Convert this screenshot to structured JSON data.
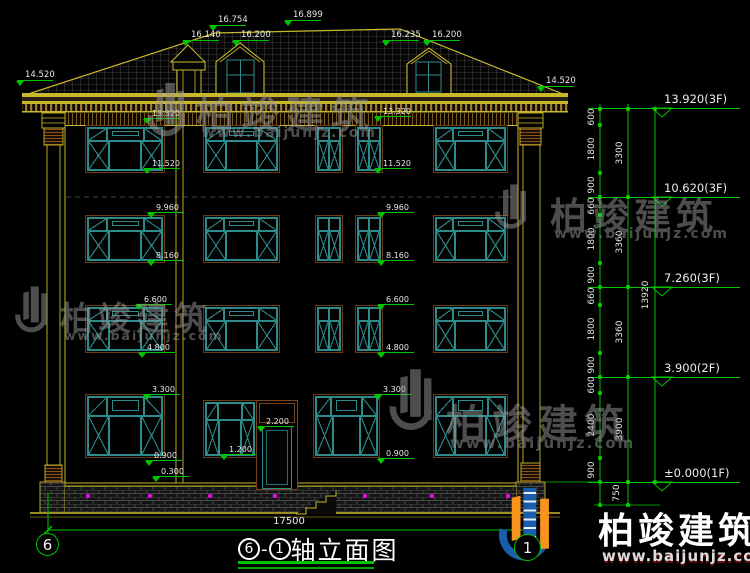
{
  "title": {
    "axis_left_bubble": "6",
    "axis_right_bubble": "1",
    "circled_left": "6",
    "dash": "-",
    "circled_right": "1",
    "text": "轴立面图"
  },
  "bottom_dimension": "17500",
  "brand": {
    "cn": "柏竣建筑",
    "url": "www.baijunjz.com"
  },
  "watermark": {
    "cn": "柏竣建筑",
    "url": "www.baijunjz.com"
  },
  "colors": {
    "cad_yellow": "#c9b92a",
    "cad_green": "#00c400",
    "window_teal": "#2e8b8b",
    "frame_brown": "#7a4418",
    "dim_text": "#e6e6e6",
    "magenta": "#ff00ff",
    "brand_blue": "#1a5dac",
    "brand_orange": "#f7941d",
    "watermark_gray": "#9a9a9a"
  },
  "top_labels": [
    {
      "t": "16.754",
      "x": 218,
      "y": 16
    },
    {
      "t": "16.899",
      "x": 293,
      "y": 11
    },
    {
      "t": "16.140",
      "x": 191,
      "y": 31
    },
    {
      "t": "16.200",
      "x": 241,
      "y": 31
    },
    {
      "t": "16.235",
      "x": 391,
      "y": 31
    },
    {
      "t": "16.200",
      "x": 432,
      "y": 31
    },
    {
      "t": "14.520",
      "x": 25,
      "y": 71
    },
    {
      "t": "14.520",
      "x": 546,
      "y": 77
    }
  ],
  "facade_labels": [
    {
      "t": "13.320",
      "x": 152,
      "y": 109
    },
    {
      "t": "11.520",
      "x": 152,
      "y": 159
    },
    {
      "t": "9.960",
      "x": 156,
      "y": 203
    },
    {
      "t": "8.160",
      "x": 156,
      "y": 251
    },
    {
      "t": "6.600",
      "x": 144,
      "y": 295
    },
    {
      "t": "4.800",
      "x": 147,
      "y": 343
    },
    {
      "t": "3.300",
      "x": 152,
      "y": 385
    },
    {
      "t": "0.900",
      "x": 154,
      "y": 451
    },
    {
      "t": "0.300",
      "x": 161,
      "y": 467
    },
    {
      "t": "13.320",
      "x": 383,
      "y": 107
    },
    {
      "t": "11.520",
      "x": 383,
      "y": 159
    },
    {
      "t": "9.960",
      "x": 386,
      "y": 203
    },
    {
      "t": "8.160",
      "x": 386,
      "y": 251
    },
    {
      "t": "6.600",
      "x": 386,
      "y": 295
    },
    {
      "t": "4.800",
      "x": 386,
      "y": 343
    },
    {
      "t": "3.300",
      "x": 383,
      "y": 385
    },
    {
      "t": "0.900",
      "x": 386,
      "y": 449
    },
    {
      "t": "2.200",
      "x": 266,
      "y": 417
    },
    {
      "t": "1.200",
      "x": 229,
      "y": 445
    }
  ],
  "floor_levels": [
    {
      "t": "13.920(3F)",
      "y": 108
    },
    {
      "t": "10.620(3F)",
      "y": 197
    },
    {
      "t": "7.260(3F)",
      "y": 287
    },
    {
      "t": "3.900(2F)",
      "y": 377
    },
    {
      "t": "±0.000(1F)",
      "y": 482
    }
  ],
  "dim_chain": {
    "col1": [
      {
        "t": "600",
        "y": 117
      },
      {
        "t": "1800",
        "y": 149
      },
      {
        "t": "900",
        "y": 185
      },
      {
        "t": "660",
        "y": 206
      },
      {
        "t": "1800",
        "y": 239
      },
      {
        "t": "900",
        "y": 275
      },
      {
        "t": "660",
        "y": 296
      },
      {
        "t": "1800",
        "y": 329
      },
      {
        "t": "900",
        "y": 365
      },
      {
        "t": "600",
        "y": 385
      },
      {
        "t": "2400",
        "y": 425
      },
      {
        "t": "900",
        "y": 470
      }
    ],
    "col2": [
      {
        "t": "3300",
        "y": 153
      },
      {
        "t": "3360",
        "y": 242
      },
      {
        "t": "3360",
        "y": 332
      },
      {
        "t": "3900",
        "y": 429
      },
      {
        "t": "750",
        "y": 493
      }
    ],
    "total": {
      "t": "13920",
      "y": 295
    }
  }
}
